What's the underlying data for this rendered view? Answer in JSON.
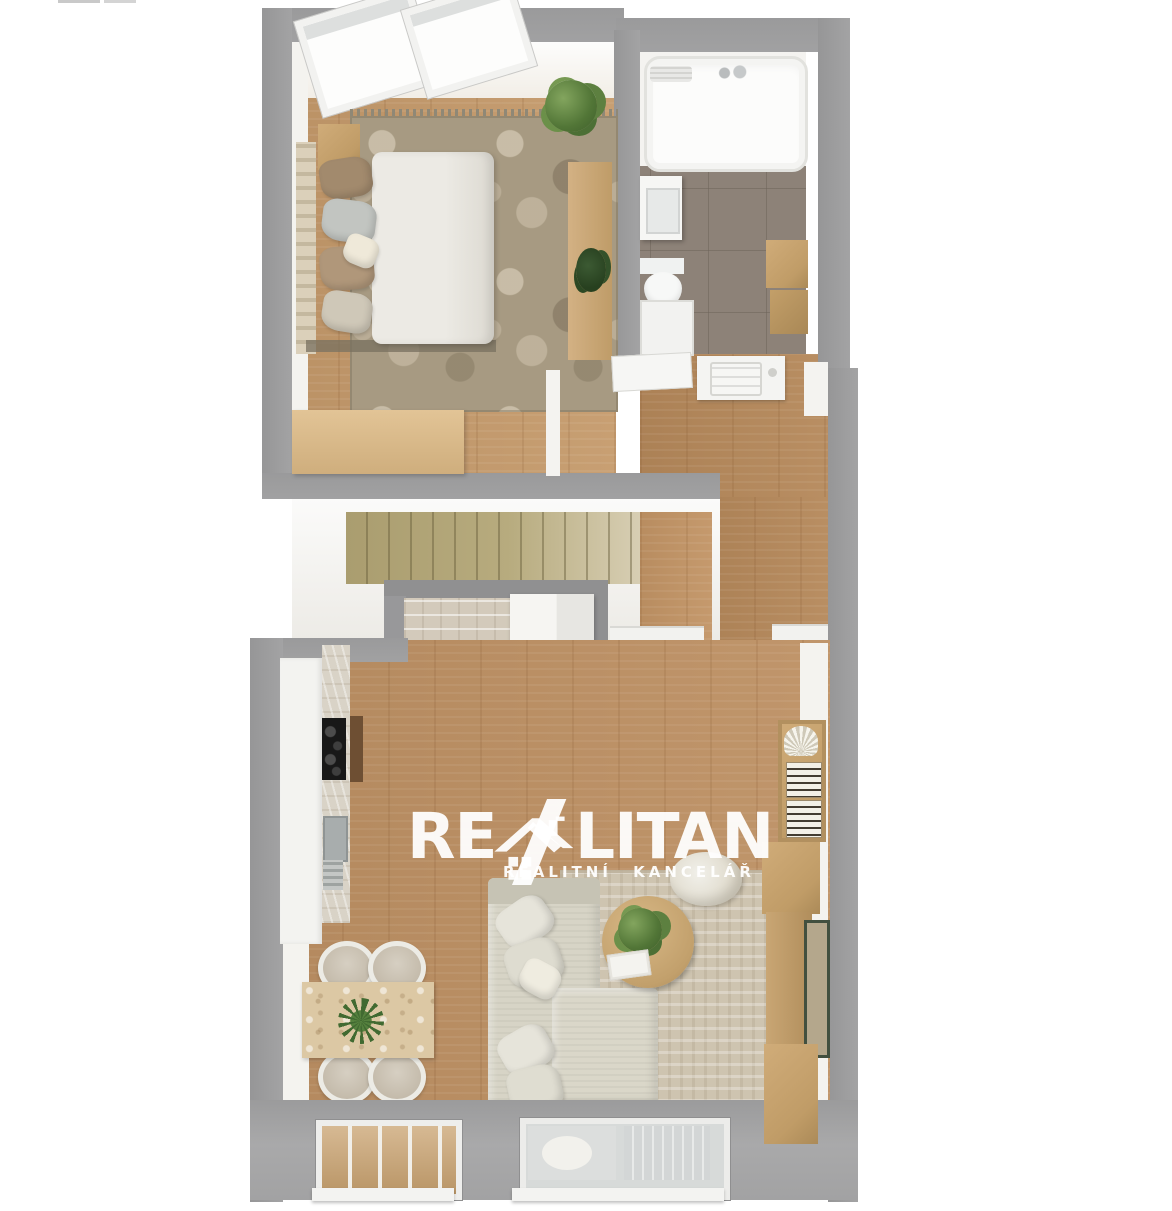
{
  "scene": {
    "type": "3d-floor-plan-render",
    "rooms": [
      "bedroom",
      "bathroom",
      "staircase-hall",
      "kitchen-living-dining-room"
    ],
    "furniture": [
      "double-bed",
      "nightstand",
      "bedroom-rug",
      "potted-plant",
      "desk",
      "sideboard",
      "bathtub",
      "washbasin",
      "toilet",
      "washing-machine",
      "bathroom-cabinets",
      "staircase",
      "kitchen-counter",
      "cooktop",
      "kitchen-sink",
      "dining-table",
      "dining-chairs",
      "corner-sofa",
      "coffee-table",
      "pouf",
      "living-rug",
      "bookshelf",
      "tv-cabinets",
      "picture-frame",
      "skylight-windows"
    ]
  },
  "watermark": {
    "brand_prefix": "RE",
    "brand_suffix": "LITAN",
    "tagline": "REALITNÍ KANCELÁŘ",
    "logo": "realitan-house-logo",
    "color": "#ffffff"
  },
  "palette": {
    "page_background": "#ffffff",
    "wall_gray": "#9a9a9b",
    "roof_gray": "#a5a5a6",
    "inner_wall_white": "#f4f3f0",
    "wood_floor": "#bd9063",
    "wood_floor_bedroom": "#c59a6b",
    "wood_floor_hall": "#b5885a",
    "bedroom_rug": "#a79a82",
    "living_rug": "#cec4b0",
    "stairs": "#b7ab7e",
    "bathroom_tile": "#8d8278",
    "furniture_tan": "#c7a472",
    "sofa": "#d7d4c6",
    "cooktop_black": "#181818",
    "plant_green": "#527637"
  }
}
